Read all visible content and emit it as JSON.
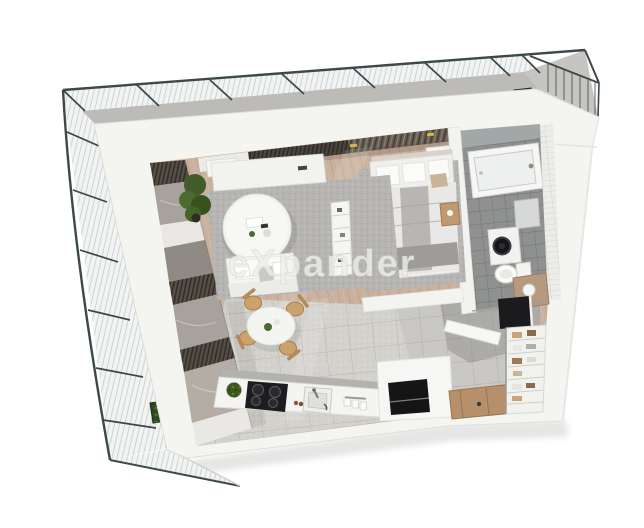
{
  "image": {
    "kind": "3d-floor-plan-render",
    "description": "Top-down 3D render of a studio apartment with wrap-around glass balcony, living-dining area, bedroom, bathroom, kitchen and entrance hall"
  },
  "watermark": {
    "text": "eXpander",
    "color": "#ededec"
  },
  "palette": {
    "background": "#ffffff",
    "wall": "#f4f4f1",
    "wood_floor": "#c9b19d",
    "tile_light": "#d3d2cd",
    "tile_hall": "#c9c8c4",
    "tile_bath": "#8f9191",
    "rug": "#b6b5b3",
    "railing": "#3d4949",
    "concrete": "#bcbbb7",
    "plant_green": "#4c6b31",
    "door_wood": "#b5906a",
    "chair_wood": "#c9a36b",
    "dark_slats": "#544f47",
    "stone_panel": "#a7a29b"
  },
  "rooms": [
    {
      "name": "balcony"
    },
    {
      "name": "living-room"
    },
    {
      "name": "dining-area"
    },
    {
      "name": "bedroom"
    },
    {
      "name": "bathroom"
    },
    {
      "name": "kitchen"
    },
    {
      "name": "hallway"
    },
    {
      "name": "wardrobe"
    }
  ],
  "objects": [
    "glass-railing",
    "planter-box",
    "sofa",
    "coffee-table",
    "tv-sideboard",
    "potted-plant",
    "shelf-divider",
    "dining-table",
    "dining-chair",
    "double-bed",
    "bedside-stool",
    "bathtub",
    "washing-machine",
    "toilet",
    "vanity",
    "mirror-cabinet",
    "kitchen-counter",
    "induction-hob",
    "kitchen-sink",
    "entrance-door",
    "wardrobe-shelves"
  ]
}
